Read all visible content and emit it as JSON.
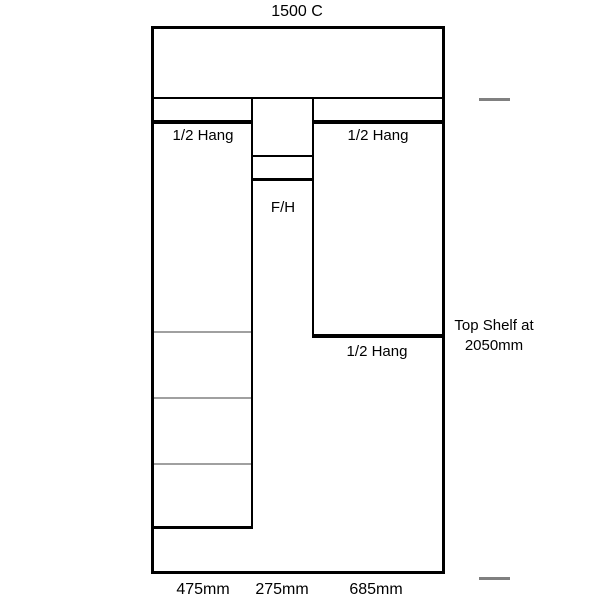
{
  "diagram": {
    "title": "1500 C",
    "note": {
      "line1": "Top Shelf at",
      "line2": "2050mm"
    },
    "sections": {
      "left": {
        "top_label": "1/2 Hang",
        "width_label": "475mm"
      },
      "middle": {
        "label": "F/H",
        "width_label": "275mm"
      },
      "right": {
        "top_label": "1/2 Hang",
        "bottom_label": "1/2 Hang",
        "width_label": "685mm"
      }
    },
    "colors": {
      "outline": "#000000",
      "shelf_gray": "#a0a0a0",
      "dash_gray": "#808080"
    }
  }
}
